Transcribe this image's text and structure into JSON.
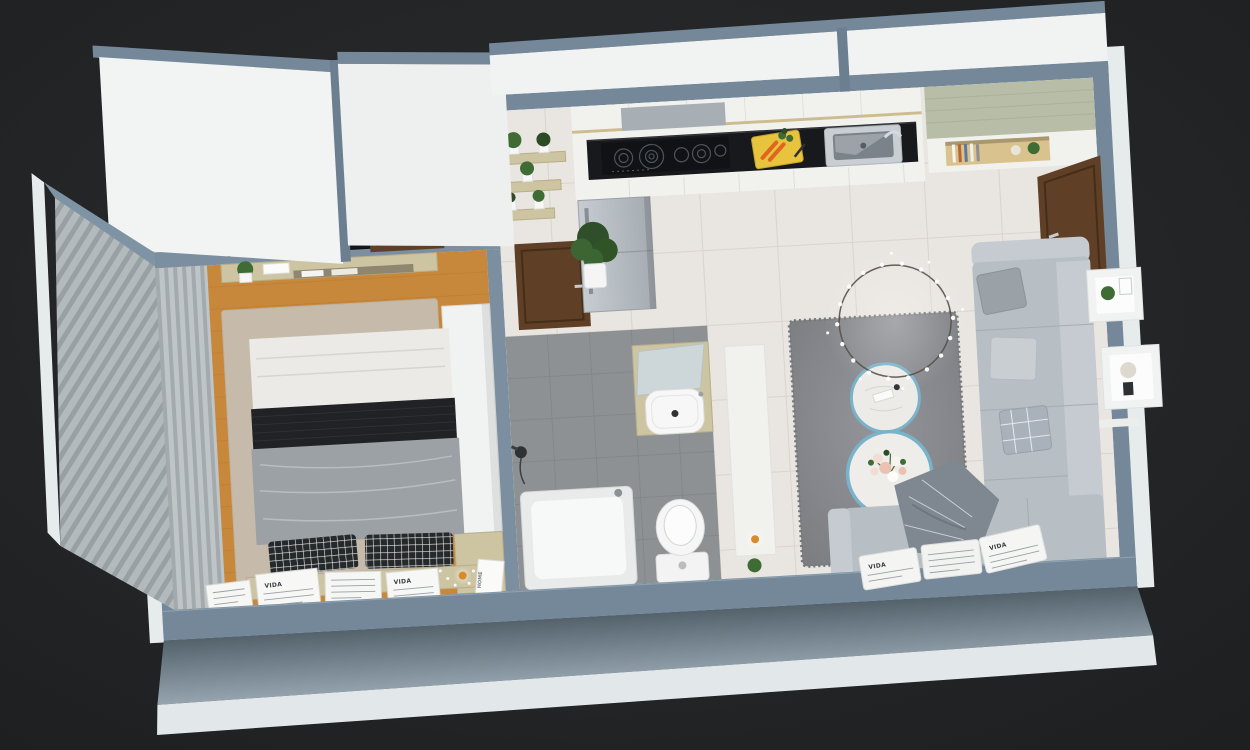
{
  "scene": {
    "type": "3d-render",
    "subject": "Isometric cutaway render of a small one-bedroom apartment floor plan",
    "rooms": [
      {
        "name": "bedroom",
        "furniture": [
          "double-bed",
          "black-runner-blanket",
          "gray-duvet",
          "checkered-pillows",
          "wall-tv",
          "media-console",
          "vertical-curtain-wall",
          "framed-prints",
          "white-wardrobe",
          "area-rug",
          "wood-floor"
        ]
      },
      {
        "name": "kitchen",
        "furniture": [
          "refrigerator",
          "range-hood",
          "induction-cooktop",
          "cutting-board-with-carrots",
          "stainless-sink",
          "upper-cabinets",
          "base-cabinets",
          "plant-shelves",
          "potted-plant"
        ]
      },
      {
        "name": "bathroom",
        "furniture": [
          "walnut-door",
          "vanity-mirror",
          "vessel-sink",
          "toilet",
          "bathtub",
          "shower-head",
          "gray-tile-floor"
        ]
      },
      {
        "name": "living-room",
        "furniture": [
          "l-shaped-sofa",
          "throw-pillows",
          "plaid-throw",
          "round-coffee-tables",
          "flower-bouquet",
          "ring-branch-chandelier",
          "shag-rug",
          "cube-wall-shelves",
          "side-cabinet",
          "typography-cushions"
        ]
      },
      {
        "name": "entry",
        "furniture": [
          "entrance-door",
          "console-cabinet",
          "book-niche"
        ]
      }
    ]
  },
  "texts": {
    "frame_word": "VIDA",
    "pillow_word": "VIDA",
    "magazine_word": "HOME"
  },
  "colors": {
    "bg_mid": "#2c2e30",
    "bg_dark": "#1d1f21",
    "wall_top": "#74889a",
    "wall_int": "#7b8fa0",
    "wall_face": "#f0f3f2",
    "outer_band": "#e6ebec",
    "parapet_face_dark": "#54626c",
    "parapet_face_light": "#95a4ae",
    "tile": "#e9e5e0",
    "tile_line": "#d9d4ce",
    "wood_floor": "#c8883c",
    "wood_line": "#b5762f",
    "rug_beige": "#c6bbaa",
    "bath_tile": "#8d9193",
    "bath_line": "#7d8183",
    "door_wood": "#5f4026",
    "door_frame": "#452d18",
    "counter_black": "#17191c",
    "cabinet_white": "#f1f1ee",
    "fridge_light": "#c6ccd1",
    "fridge_dark": "#a4abb1",
    "sofa": "#b7bec4",
    "sofa_light": "#c5cbd0",
    "duvet": "#9ca1a5",
    "blanket_black": "#202225",
    "shelf_wood": "#cdc4a2",
    "sage_top": "#b7bda6",
    "table_rim": "#79b3c9",
    "rug_gray": "#8a8c90",
    "plant_green": "#3f6b34",
    "plant_dark": "#2c4b26",
    "amber": "#d98a2b",
    "carrot": "#e0651f",
    "board_yellow": "#e7c33e",
    "steel": "#c9ced2",
    "white": "#f6f7f6"
  }
}
